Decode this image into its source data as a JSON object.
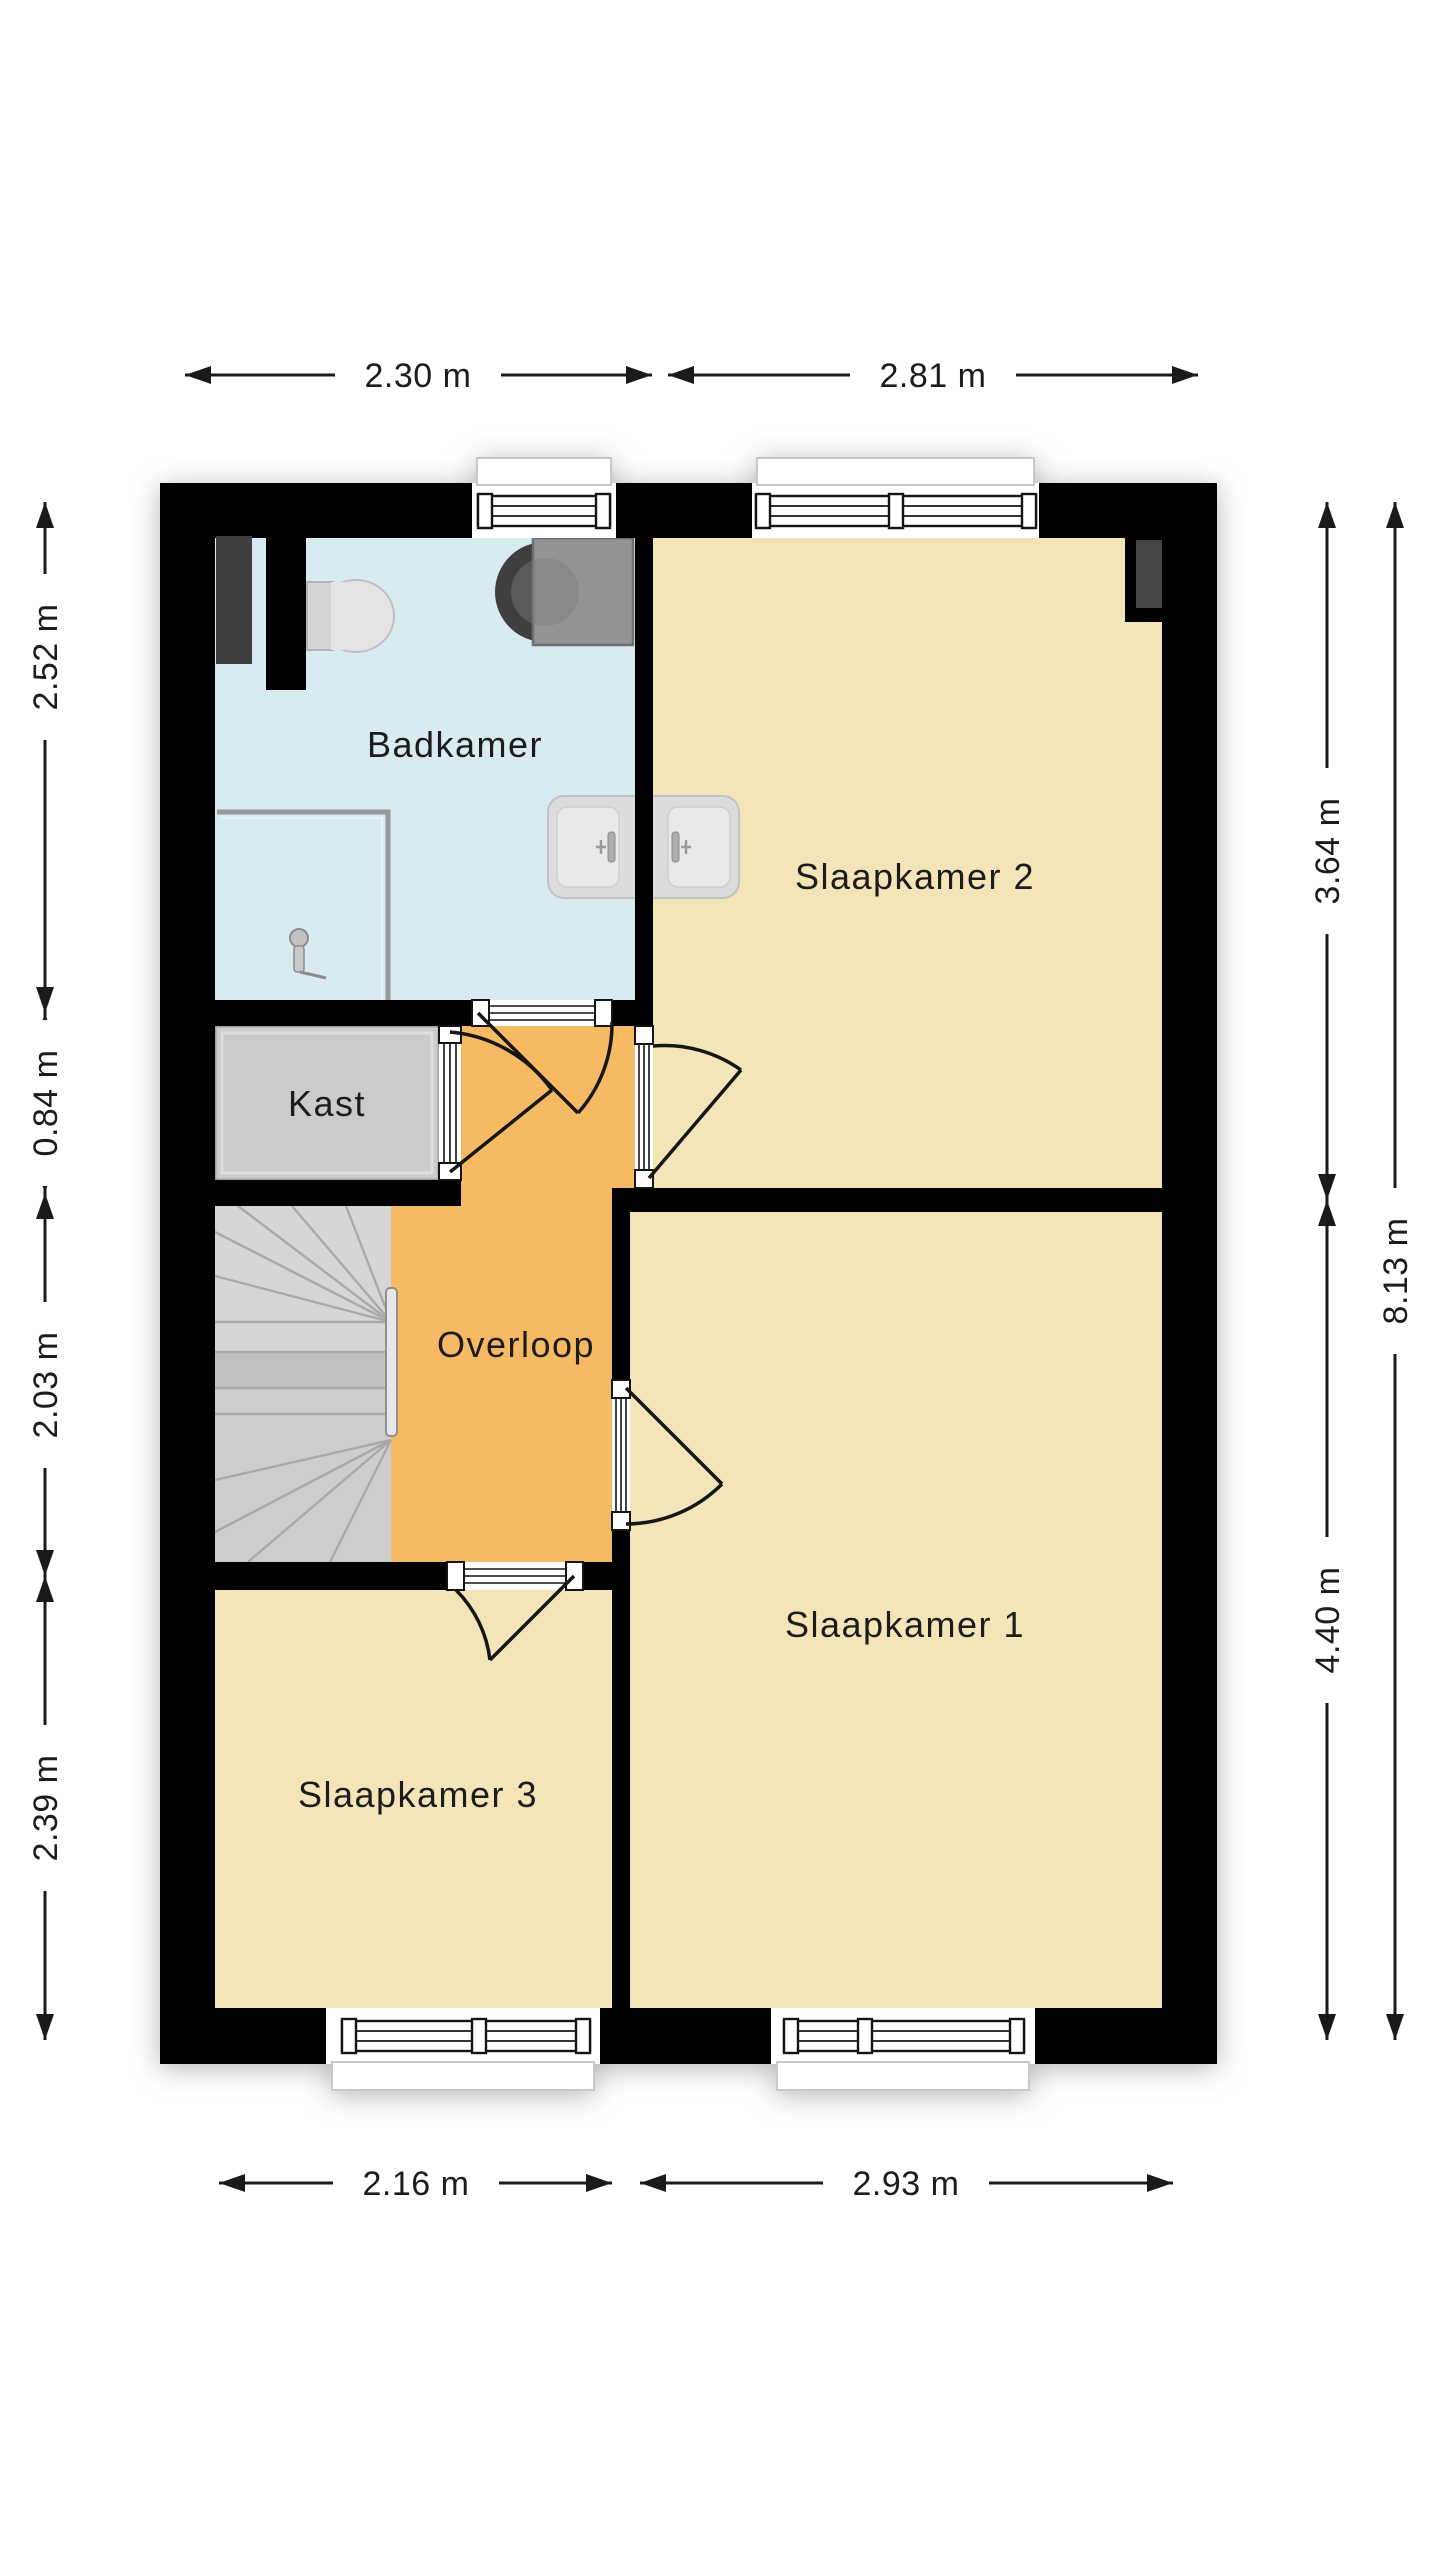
{
  "floorplan": {
    "type": "floor-plan",
    "language": "nl",
    "rooms": [
      {
        "id": "badkamer",
        "label": "Badkamer",
        "color": "#d8eaf2"
      },
      {
        "id": "slaapkamer2",
        "label": "Slaapkamer 2",
        "color": "#f3e5b8"
      },
      {
        "id": "kast",
        "label": "Kast",
        "color": "#cbcbcb"
      },
      {
        "id": "overloop",
        "label": "Overloop",
        "color": "#f6ba64"
      },
      {
        "id": "slaapkamer1",
        "label": "Slaapkamer 1",
        "color": "#f3e5b8"
      },
      {
        "id": "slaapkamer3",
        "label": "Slaapkamer 3",
        "color": "#f3e5b8"
      }
    ],
    "dimensions": {
      "top": [
        {
          "label": "2.30 m"
        },
        {
          "label": "2.81 m"
        }
      ],
      "bottom": [
        {
          "label": "2.16 m"
        },
        {
          "label": "2.93 m"
        }
      ],
      "left": [
        {
          "label": "2.52 m"
        },
        {
          "label": "0.84 m"
        },
        {
          "label": "2.03 m"
        },
        {
          "label": "2.39 m"
        }
      ],
      "right": [
        {
          "label": "3.64 m"
        },
        {
          "label": "4.40 m"
        },
        {
          "label": "8.13 m"
        }
      ]
    },
    "fixtures": [
      {
        "name": "toilet"
      },
      {
        "name": "washing-machine"
      },
      {
        "name": "shower"
      },
      {
        "name": "double-washbasin"
      },
      {
        "name": "winder-staircase"
      },
      {
        "name": "stair-handrail"
      },
      {
        "name": "radiator-duct-left"
      },
      {
        "name": "radiator-duct-right"
      }
    ],
    "colors": {
      "wall": "#000000",
      "stairs": "#cdcdcd",
      "stairs_band": "#c0c0c0",
      "fixture_gray": "#949494",
      "fixture_light": "#e0e0e0",
      "duct_dark": "#3e3e3e"
    }
  }
}
